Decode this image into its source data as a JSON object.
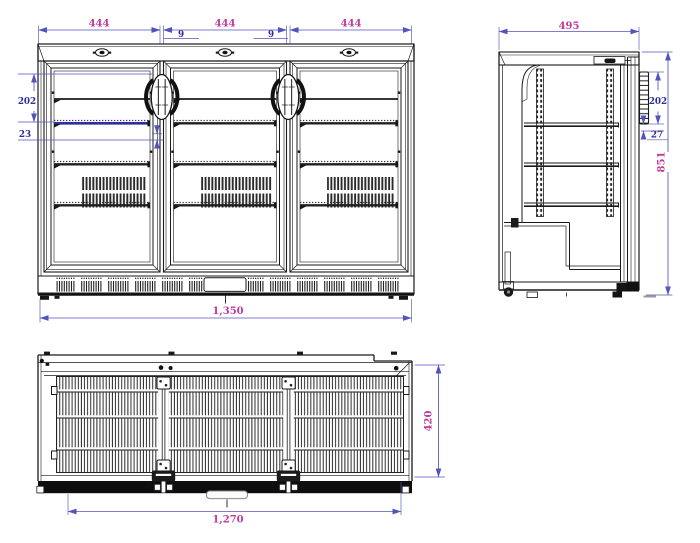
{
  "colors": {
    "background": "#ffffff",
    "line": "#1a1a1a",
    "dim_line": "#5353bd",
    "dim_text_blue": "#2e2e96",
    "dim_text_magenta": "#c23b9c"
  },
  "front_view": {
    "door_width_dims": [
      "444",
      "444",
      "444"
    ],
    "door_gap_dims": [
      "9",
      "9"
    ],
    "top_shelf_height_dim": "202",
    "shelf_clearance_dim": "23",
    "overall_width_dim": "1,350"
  },
  "side_view": {
    "overall_depth_dim": "495",
    "handle_length_dim": "202",
    "handle_clearance_dim": "27",
    "overall_height_dim": "851"
  },
  "bottom_view": {
    "body_depth_dim": "420",
    "base_width_dim": "1,270"
  }
}
